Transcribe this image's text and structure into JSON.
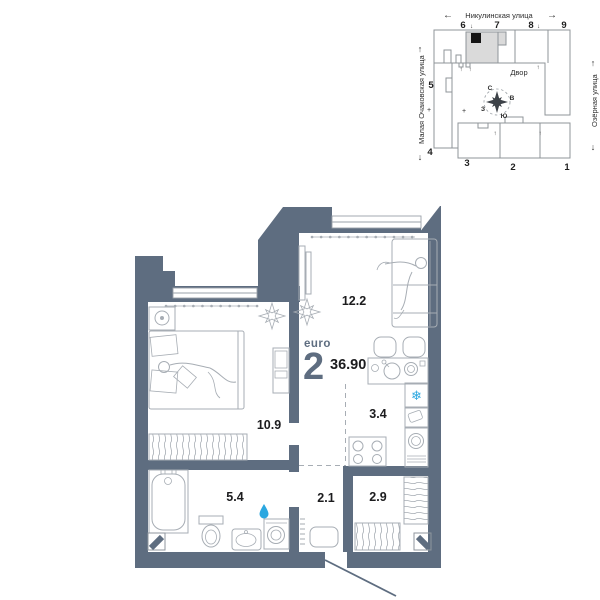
{
  "site_plan": {
    "street_top": "Никулинская улица",
    "street_left": "Малая Очаковская улица",
    "street_right": "Озёрная улица",
    "courtyard": "Двор",
    "compass": {
      "n": "С",
      "e": "В",
      "s": "Ю",
      "w": "З"
    },
    "numbers": {
      "n1": "1",
      "n2": "2",
      "n3": "3",
      "n4": "4",
      "n5": "5",
      "n6": "6",
      "n7": "7",
      "n8": "8",
      "n9": "9"
    },
    "arrows": {
      "left": "←",
      "right": "→",
      "up": "↑",
      "down": "↓",
      "plus": "+"
    }
  },
  "apartment": {
    "type_label": "euro",
    "rooms_count": "2",
    "total_area": "36.90",
    "areas": {
      "living_room": "12.2",
      "bedroom": "10.9",
      "kitchen": "3.4",
      "bathroom": "5.4",
      "hall": "2.1",
      "wardrobe": "2.9"
    }
  },
  "icons": {
    "snowflake": "❄"
  },
  "colors": {
    "wall": "#5e6d80",
    "accent_blue": "#2ba7e0",
    "furniture_line": "#a7adb4",
    "site_line": "#8f9499",
    "label": "#1c1c1e",
    "section_highlight": "#dadada",
    "unit_marker": "#151515"
  }
}
